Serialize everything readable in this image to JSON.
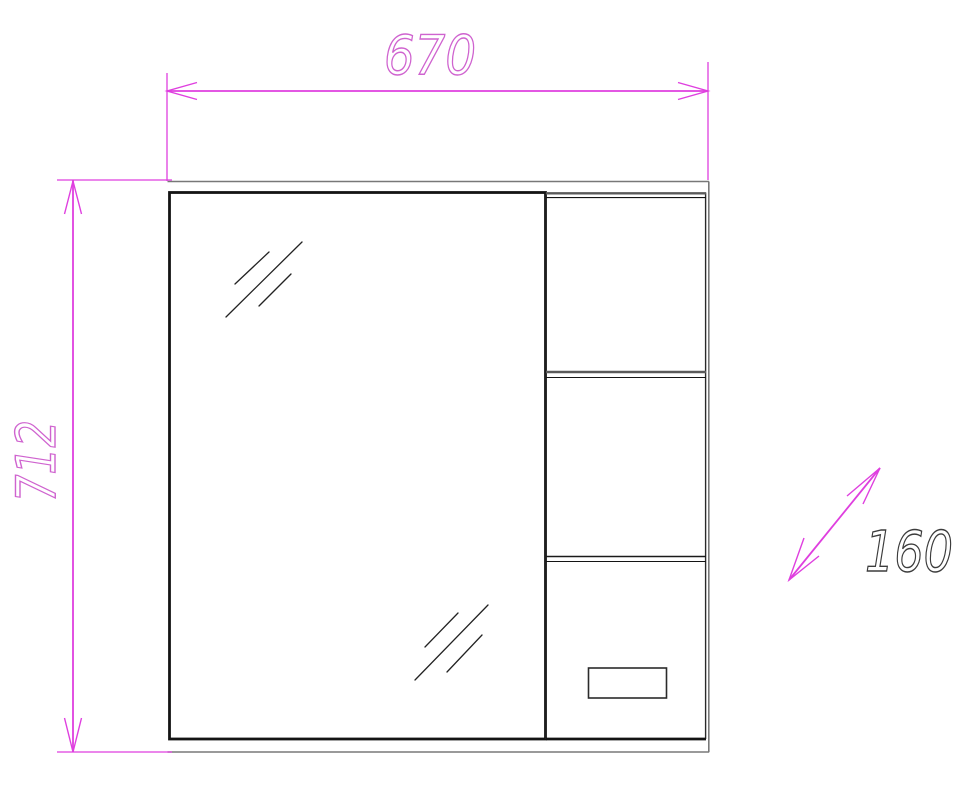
{
  "drawing": {
    "type": "furniture-dimension-drawing",
    "object": "mirror-cabinet-front-view",
    "dimensions": {
      "width": {
        "label": "670"
      },
      "height": {
        "label": "712"
      },
      "depth": {
        "label": "160"
      }
    },
    "colors": {
      "dimension_line": "#df3fdf",
      "dimension_text_stroke": "#cf63cf",
      "depth_text_stroke": "#3c3c3c",
      "outline_dark": "#141414",
      "outline_gray": "#787878",
      "background": "#ffffff"
    }
  }
}
